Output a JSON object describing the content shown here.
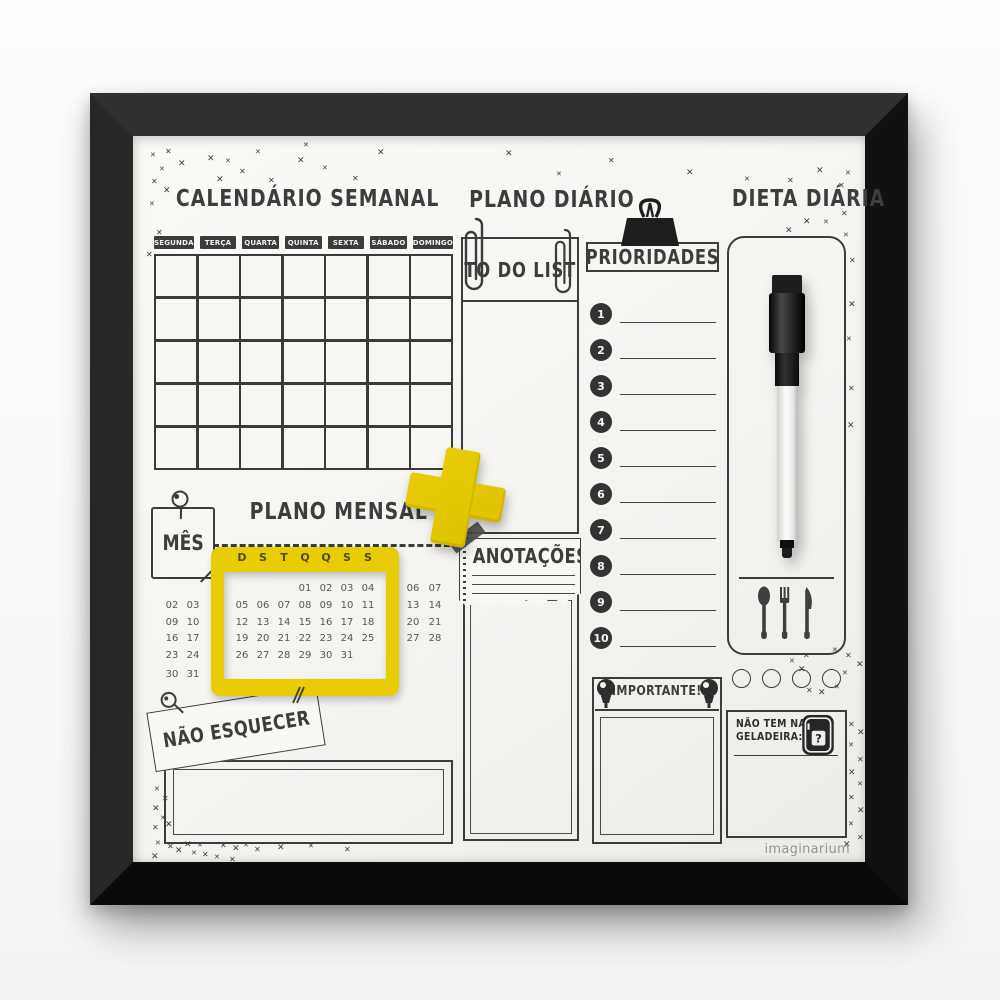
{
  "brand": "imaginarium",
  "decoration_glyph": "✕",
  "colors": {
    "accent_yellow": "#e8cd05",
    "ink": "#3c3c3c",
    "board_white": "#f6f5f2",
    "frame_black": "#181818"
  },
  "weekly_calendar": {
    "title": "CALENDÁRIO SEMANAL",
    "days": [
      "SEGUNDA",
      "TERÇA",
      "QUARTA",
      "QUINTA",
      "SEXTA",
      "SÁBADO",
      "DOMINGO"
    ],
    "grid_rows": 5,
    "grid_cols": 7
  },
  "daily_plan": {
    "title": "PLANO DIÁRIO",
    "todo_label": "TO DO LIST"
  },
  "priorities": {
    "title": "PRIORIDADES",
    "items": [
      "1",
      "2",
      "3",
      "4",
      "5",
      "6",
      "7",
      "8",
      "9",
      "10"
    ]
  },
  "daily_diet": {
    "title": "DIETA DIÁRIA",
    "meal_circles": 4
  },
  "monthly_plan": {
    "title": "PLANO MENSAL",
    "month_tag": "MÊS",
    "weekday_letters": [
      "D",
      "S",
      "T",
      "Q",
      "Q",
      "S",
      "S"
    ],
    "window_rows": [
      [
        "",
        "",
        "",
        "01",
        "02",
        "03",
        "04"
      ],
      [
        "05",
        "06",
        "07",
        "08",
        "09",
        "10",
        "11"
      ],
      [
        "12",
        "13",
        "14",
        "15",
        "16",
        "17",
        "18"
      ],
      [
        "19",
        "20",
        "21",
        "22",
        "23",
        "24",
        "25"
      ],
      [
        "26",
        "27",
        "28",
        "29",
        "30",
        "31",
        ""
      ]
    ],
    "left_columns_rows": [
      [
        "02",
        "03"
      ],
      [
        "09",
        "10"
      ],
      [
        "16",
        "17"
      ],
      [
        "23",
        "24"
      ],
      [
        "30",
        "31"
      ]
    ],
    "right_columns_rows": [
      [
        "06",
        "07"
      ],
      [
        "13",
        "14"
      ],
      [
        "20",
        "21"
      ],
      [
        "27",
        "28"
      ]
    ]
  },
  "notes": {
    "title": "ANOTAÇÕES"
  },
  "dont_forget": {
    "title": "NÃO ESQUECER"
  },
  "important": {
    "title": "IMPORTANTE!"
  },
  "fridge_note": {
    "line1": "NÃO TEM NA",
    "line2": "GELADEIRA:",
    "icon_mark": "?"
  }
}
